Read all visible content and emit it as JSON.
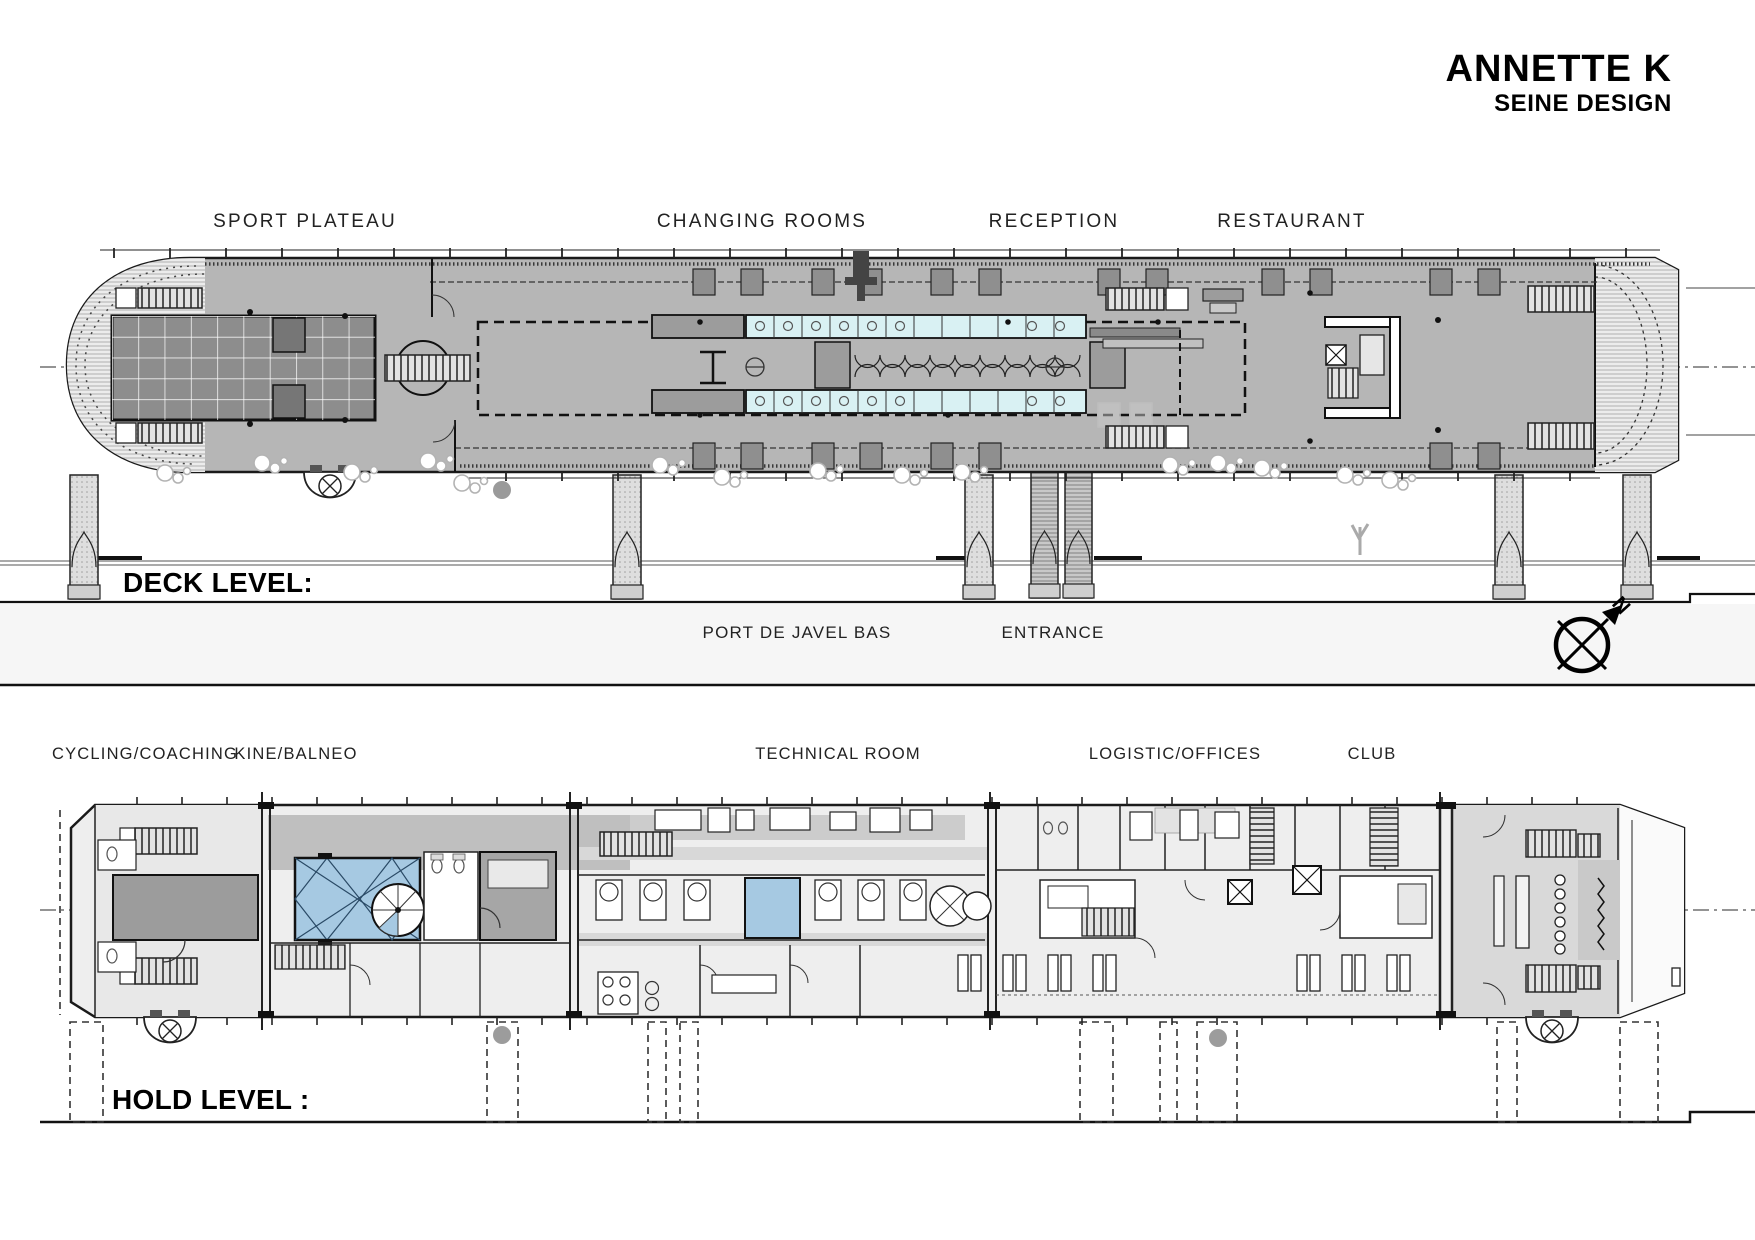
{
  "header": {
    "title": "ANNETTE K",
    "subtitle": "SEINE DESIGN"
  },
  "deck": {
    "section_label": "DECK LEVEL:",
    "area_labels": [
      {
        "text": "SPORT PLATEAU"
      },
      {
        "text": "CHANGING ROOMS"
      },
      {
        "text": "RECEPTION"
      },
      {
        "text": "RESTAURANT"
      }
    ],
    "quay_labels": [
      {
        "text": "PORT DE JAVEL BAS"
      },
      {
        "text": "ENTRANCE"
      }
    ],
    "compass_label": "N"
  },
  "hold": {
    "section_label": "HOLD LEVEL :",
    "area_labels": [
      {
        "text": "CYCLING/COACHING"
      },
      {
        "text": "KINE/BALNEO"
      },
      {
        "text": "TECHNICAL ROOM"
      },
      {
        "text": "LOGISTIC/OFFICES"
      },
      {
        "text": "CLUB"
      }
    ]
  },
  "colors": {
    "ink": "#1a1a1a",
    "deck-gray": "#b6b6b6",
    "court-gray": "#8d8d8d",
    "court-dark": "#767676",
    "shower-cyan": "#d9f1f3",
    "pool-blue": "#a6c9e2",
    "club-gray": "#d9d9d9",
    "corridor-gray": "#bfbfbf",
    "dark-room": "#9c9c9c",
    "hatch-bg": "#ececec",
    "pillar-gray": "#dedede",
    "band-gray": "#f6f6f6",
    "bubble-gray": "#b3b3b3"
  }
}
